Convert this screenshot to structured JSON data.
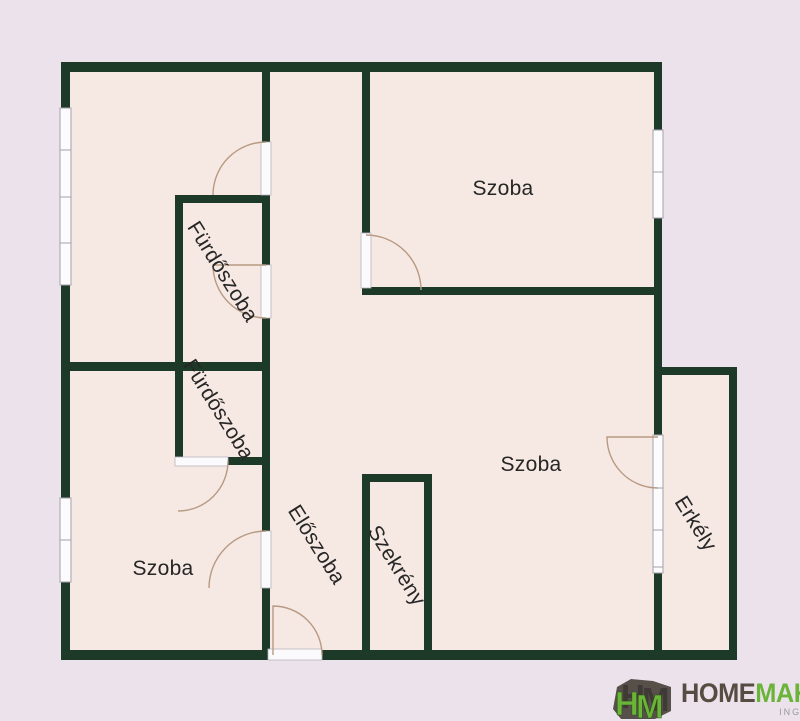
{
  "plan": {
    "type": "apartment-floor-plan",
    "rooms": {
      "szoba_top_right": "Szoba",
      "szoba_bottom_left": "Szoba",
      "szoba_bottom_right": "Szoba",
      "furdoszoba_upper": "Fürdőszoba",
      "furdoszoba_lower": "Fürdőszoba",
      "eloszoba": "Előszoba",
      "szekreny": "Szekrény",
      "erkely": "Erkély"
    },
    "colors": {
      "background": "#ece2ec",
      "floor": "#f6e8e2",
      "wall": "#1d3a28",
      "door_arc": "#b79a83",
      "window": "#fcfbfd",
      "label_text": "#262626"
    },
    "features": {
      "windows": 4,
      "door_openings": 7,
      "entrance_door": "bottom wall of Előszoba",
      "balcony_access": "door from bottom-right Szoba"
    }
  },
  "logo": {
    "icon": "homemaker-cubes-icon",
    "icon_letter_h": "H",
    "icon_letter_m": "M",
    "brand_primary": "HOME",
    "brand_secondary": "MAKER",
    "tagline": "INGATLANOK",
    "color_primary": "#564c42",
    "color_secondary": "#6ab438",
    "color_tagline": "#9a98a0"
  }
}
